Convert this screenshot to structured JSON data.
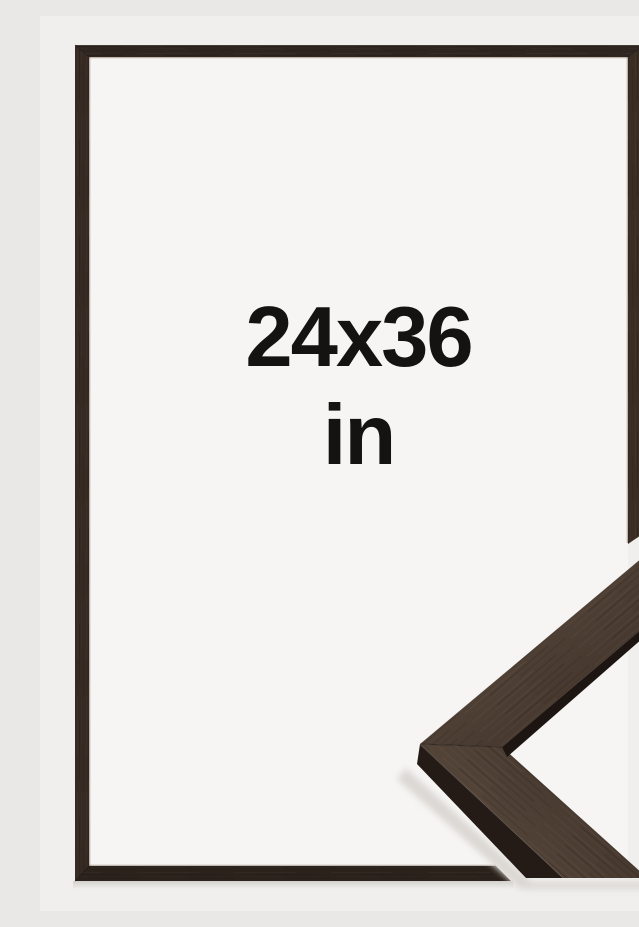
{
  "label": {
    "line1": "24x36",
    "line2": "in"
  },
  "colors": {
    "bg-outer": "#f0efed",
    "bg-inner": "#f6f5f3",
    "text": "#151312",
    "wood-top": "#2f2520",
    "wood-left": "#362a23",
    "wood-right": "#3a2d24",
    "wood-bottom": "#2c221c",
    "wood-face": "#46382e",
    "wood-face-light": "#57473b",
    "wood-side": "#241b16",
    "wood-inner-side": "#1d1511",
    "lip-highlight": "#6b5748",
    "shadow": "#dcd8d4"
  }
}
